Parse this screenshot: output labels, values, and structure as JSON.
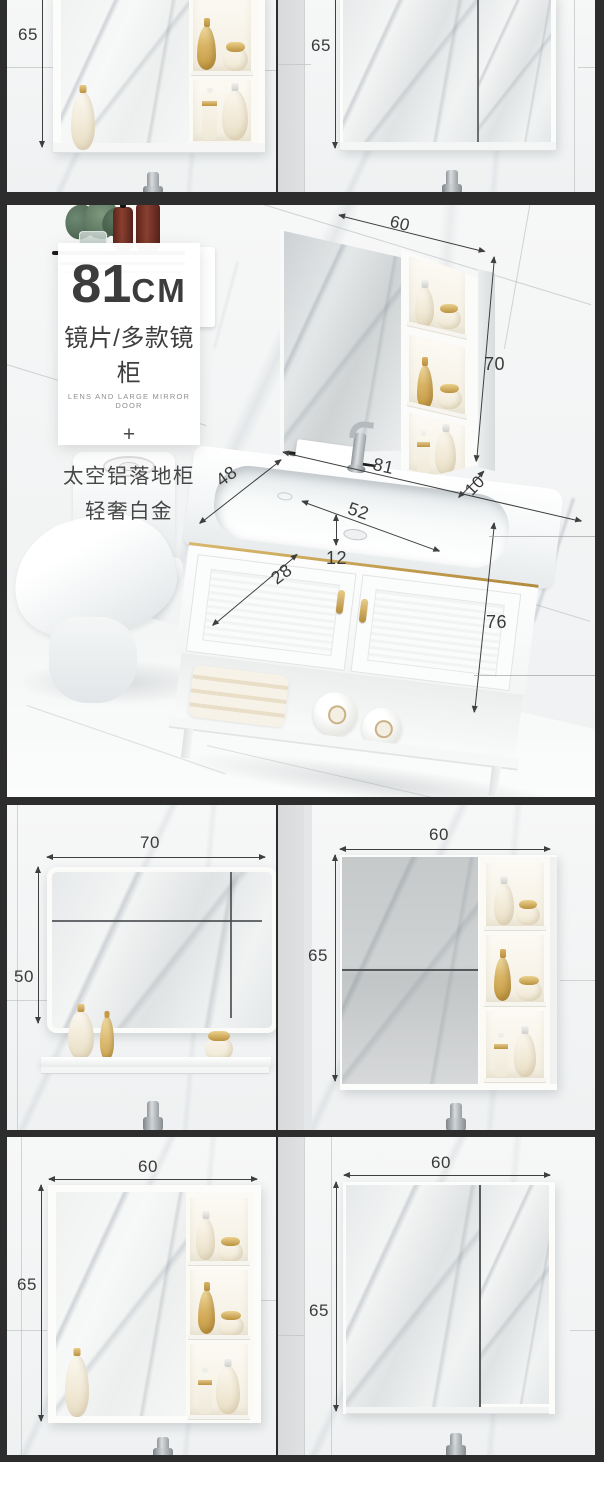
{
  "colors": {
    "frame": "#2d2d2d",
    "gold": "#c9a254",
    "dim_text": "#3a3a3a"
  },
  "s1": {
    "left": {
      "height": "65"
    },
    "right": {
      "height": "65"
    }
  },
  "hero": {
    "card": {
      "big": "81",
      "unit": "CM",
      "title_cn": "镜片/多款镜柜",
      "title_en": "LENS AND LARGE MIRROR DOOR",
      "plus": "+",
      "sub1": "太空铝落地柜",
      "sub2": "轻奢白金"
    },
    "dims": {
      "cabinet_width": "60",
      "cabinet_height": "70",
      "cabinet_depth": "10",
      "counter_width": "81",
      "basin_width": "52",
      "basin_depth": "12",
      "counter_depth": "28",
      "side_depth": "48",
      "stand_height": "76"
    }
  },
  "s3": {
    "left": {
      "width": "70",
      "height": "50"
    },
    "right": {
      "width": "60",
      "height": "65"
    }
  },
  "s4": {
    "left": {
      "width": "60",
      "height": "65"
    },
    "right": {
      "width": "60",
      "height": "65"
    }
  }
}
